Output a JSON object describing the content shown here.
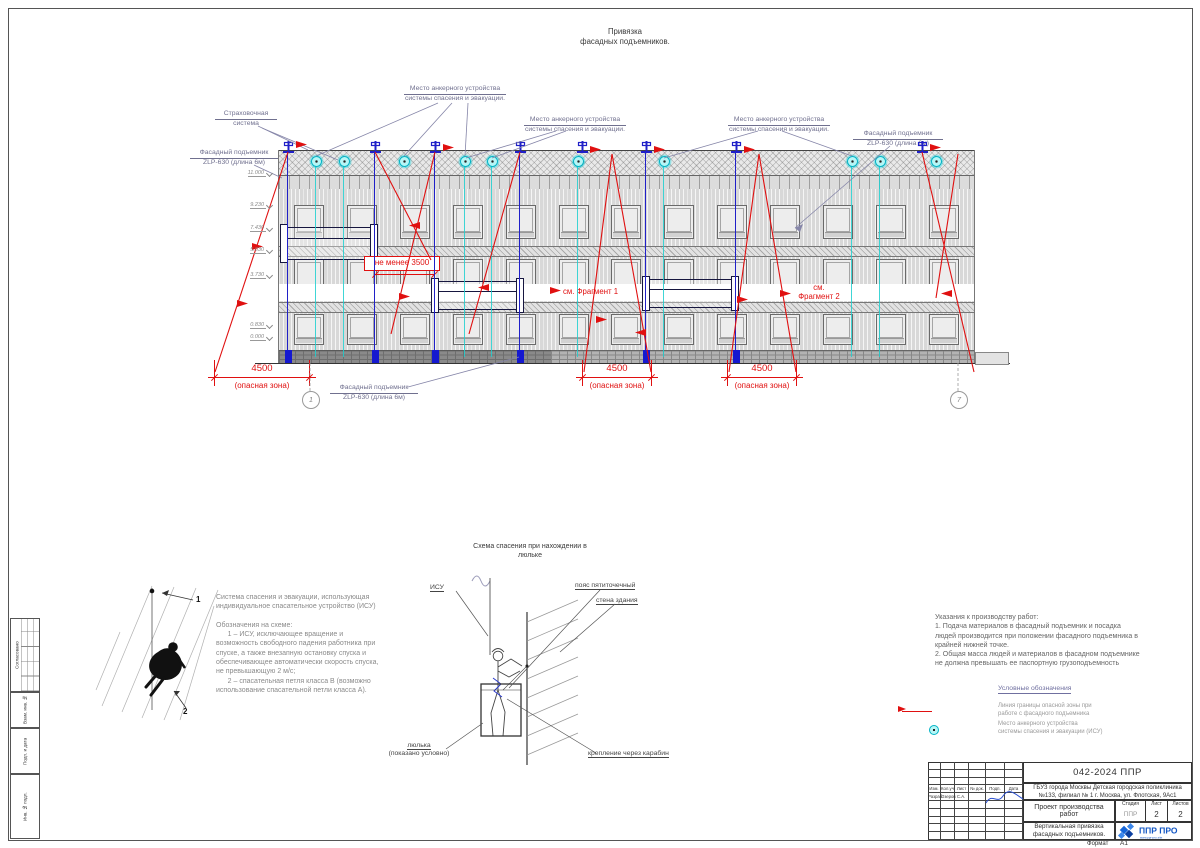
{
  "sheet": {
    "title": "Привязка\nфасадных подъемников.",
    "format_label": "Формат",
    "format_value": "А1"
  },
  "frame_strip": {
    "approved": "Согласовано",
    "vzam": "Взам. инв. №",
    "podp_data": "Подп. и дата",
    "inv_podl": "Инв. № подл."
  },
  "callouts": {
    "anchor_line1": "Место анкерного устройства",
    "anchor_line2": "системы спасения и эвакуации.",
    "safety_line1": "Страховочная",
    "safety_line2": "система",
    "lift_line1": "Фасадный подъемник",
    "lift_line2": "ZLP-630 (длина 6м)"
  },
  "dims": {
    "min350": "не менее 3500",
    "d4500": "4500",
    "danger_zone": "(опасная зона)",
    "fragment1": "см. Фрагмент 1",
    "fragment2a": "см.",
    "fragment2b": "Фрагмент 2"
  },
  "elevations": [
    "11.000",
    "9.230",
    "7.430",
    "5.030",
    "3.730",
    "0.830",
    "0.000"
  ],
  "axes": {
    "left": "1",
    "right": "7"
  },
  "isu_block": {
    "text": "Система спасения и эвакуации, использующая\nиндивидуальное спасательное устройство (ИСУ)\n\nОбозначения на схеме:\n      1 – ИСУ, исключающее вращение и\nвозможность свободного падения работника при\nспуске, а также внезапную остановку спуска и\nобеспечивающее  автоматически скорость спуска,\nне превышающую 2 м/с;\n      2 – спасательная петля класса В (возможно\nиспользование спасательной петли класса А).",
    "marker1": "1",
    "marker2": "2"
  },
  "rescue": {
    "title": "Схема спасения при нахождении в\nлюльке",
    "isu": "ИСУ",
    "belt": "пояс пятиточечный",
    "wall": "стена здания",
    "cradle1": "люлька",
    "cradle2": "(показано условно)",
    "carabiner": "крепление через карабин"
  },
  "instructions": {
    "text": "Указания к производству работ:\n1. Подача материалов в фасадный подъемник и посадка\nлюдей производится при положении фасадного подъемника в\nкрайней нижней точке.\n2. Общая масса людей и материалов в фасадном подъемнике\nне должна превышать  ее паспортную грузоподъемность"
  },
  "legend": {
    "title": "Условные обозначения",
    "item1": "Линия границы опасной зоны при\nработе с фасадного подъемника",
    "item2": "Место анкерного устройства\nсистемы спасения и эвакуации (ИСУ)"
  },
  "titleblock": {
    "doc_number": "042-2024 ППР",
    "organization": "ГБУЗ города Москвы Детская городская поликлиника №133, филиал № 1 г. Москва, ул. Флотская, 9Ас1",
    "project": "Проект производства работ",
    "stage_label": "Стадия",
    "sheet_label": "Лист",
    "sheets_label": "Листов",
    "stage": "ППР",
    "sheet": "2",
    "sheets": "2",
    "drawing_name": "Вертикальная привязка\nфасадных подъемников.",
    "cols": [
      "Изм.",
      "Кол.уч",
      "Лист",
      "№ док.",
      "Подп.",
      "Дата"
    ],
    "razrab_label": "Разраб.",
    "razrab_name": "Озеров С.А.",
    "logo_text": "ППР ПРО",
    "logo_sub": "www.ppr-pro.site"
  },
  "colors": {
    "danger": "#e01010",
    "rope_blue": "#2020c8",
    "anchor_cyan": "#00cfcf"
  }
}
